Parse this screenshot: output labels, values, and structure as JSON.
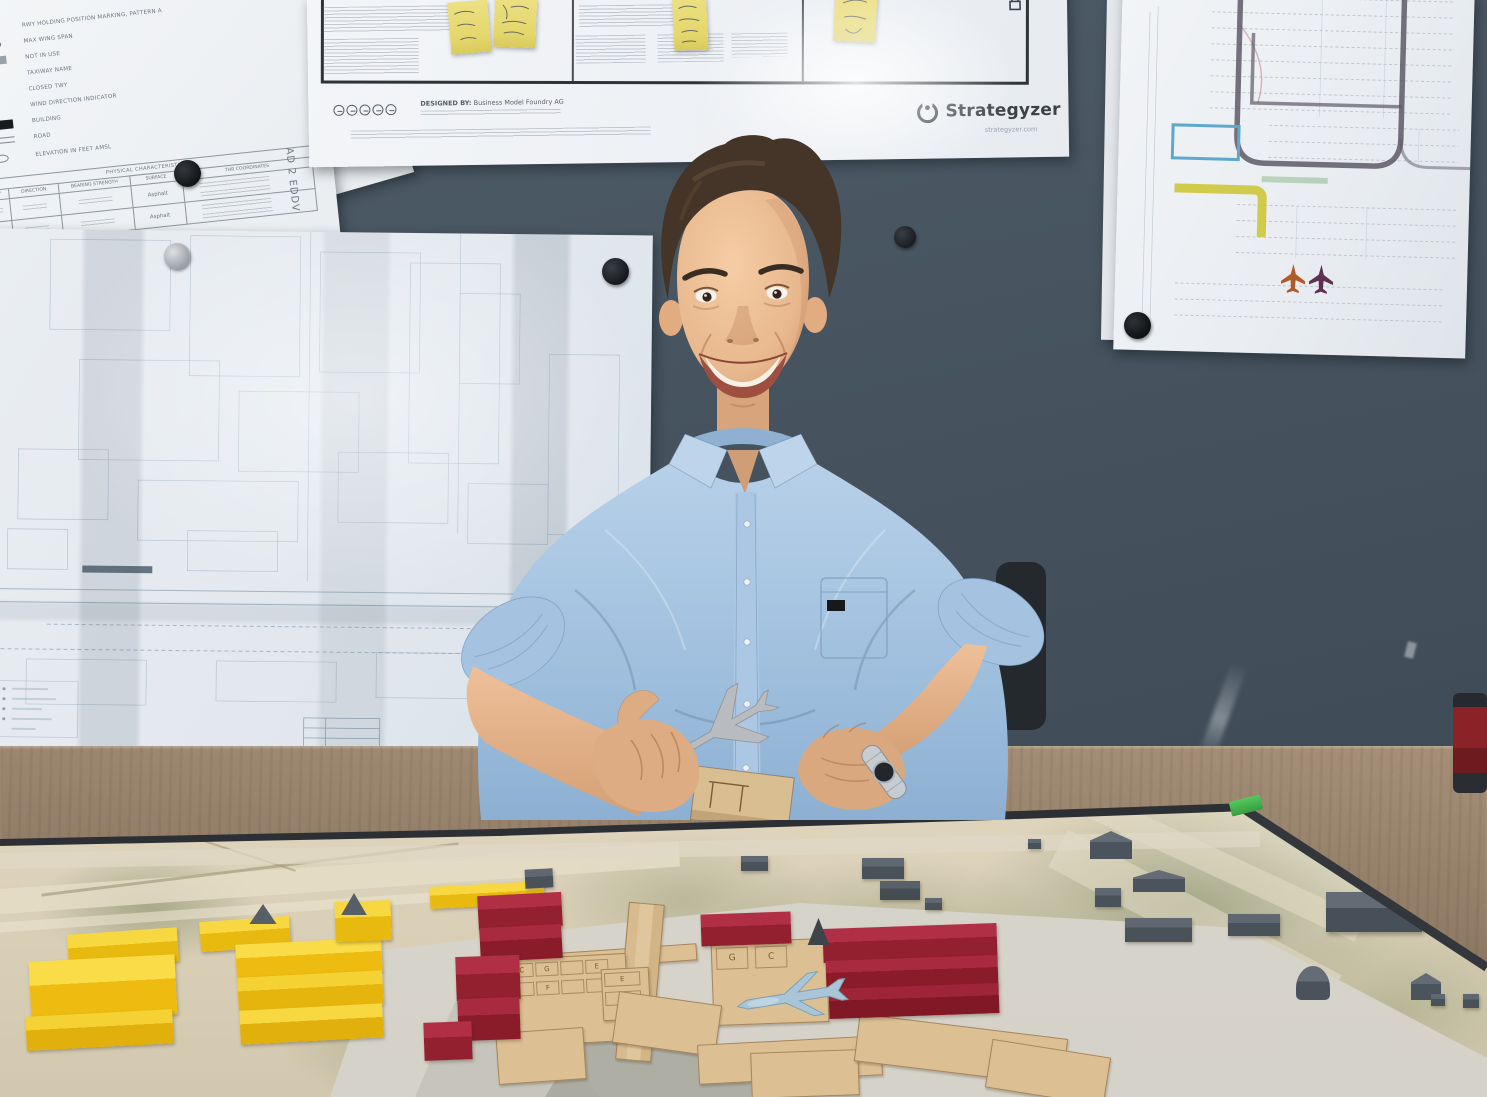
{
  "scene": {
    "type": "photograph",
    "alt": "Smiling young architect in a light blue shirt sitting at a wooden desk behind a laser-cut airport scale model, holding a small model airplane; airport charts, floor-plan blueprints and a Strategyzer Business Model Canvas with sticky notes are pinned to the dark wall behind him"
  },
  "colors": {
    "wall": "#46535f",
    "desk_wood": "#8d7660",
    "shirt_blue": "#a3c2e0",
    "skin": "#e2b088",
    "hair": "#453428",
    "paper": "#eef1f5",
    "sticky_note": "#e4d76c",
    "model_base_sand": "#d9cfb7",
    "model_base_green": "#95a07c",
    "board_frame": "#2c2f33",
    "corner_clip_green": "#43b14c",
    "apron_concrete": "#d9d6ce",
    "block_yellow": "#eebb10",
    "block_red": "#9c2738",
    "building_gray": "#4e575f",
    "terminal_wood": "#dcc094",
    "model_airplane_blue": "#a9c6d8",
    "highlight_route_yellow": "#cdc73a",
    "highlight_zone_blue": "#5fa8cd"
  },
  "posters": {
    "canvas": {
      "brand": "Strategyzer",
      "brand_url": "strategyzer.com",
      "designed_by_label": "DESIGNED BY:",
      "designed_by_value": "Business Model Foundry AG",
      "sticky_notes_count": 4
    },
    "legend": {
      "code": "AD 2 EDDV",
      "items": [
        "RWY HOLDING POSITION MARKING, PATTERN A",
        "MAX WING SPAN",
        "NOT IN USE",
        "TAXIWAY NAME",
        "CLOSED TWY",
        "WIND DIRECTION INDICATOR",
        "BUILDING",
        "ROAD",
        "ELEVATION IN FEET AMSL"
      ],
      "table_title": "PHYSICAL CHARACTERISTICS",
      "table_columns": [
        "RWY",
        "DIRECTION",
        "BEARING STRENGTH",
        "SURFACE",
        "THR COORDINATES"
      ],
      "surface_value": "Asphalt"
    },
    "parking_plan": {
      "airplane_icons": 2
    }
  },
  "model": {
    "stand_labels": [
      "C",
      "G",
      "E",
      "F"
    ]
  }
}
